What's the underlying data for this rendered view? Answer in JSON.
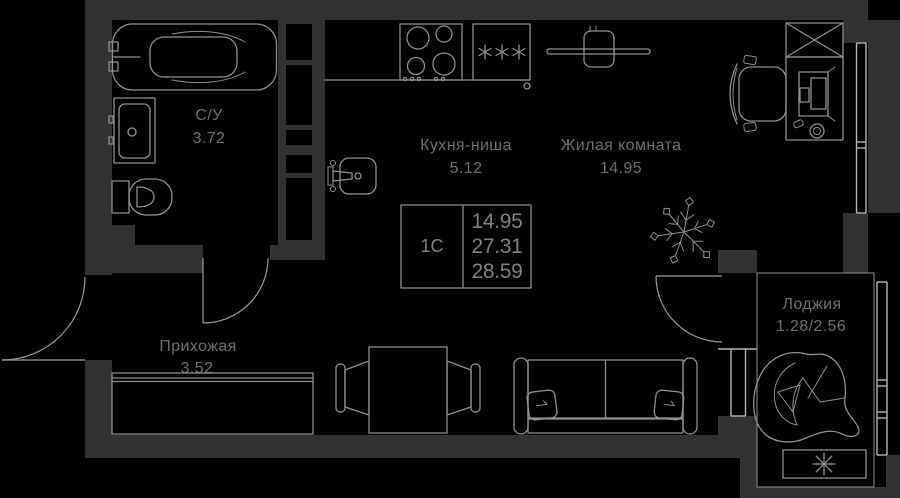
{
  "plan_type": "apartment-floor-plan",
  "info_box": {
    "unit": "1С",
    "values": [
      "14.95",
      "27.31",
      "28.59"
    ]
  },
  "rooms": [
    {
      "name": "С/У",
      "area": "3.72"
    },
    {
      "name": "Кухня-ниша",
      "area": "5.12"
    },
    {
      "name": "Жилая комната",
      "area": "14.95"
    },
    {
      "name": "Прихожая",
      "area": "3.52"
    },
    {
      "name": "Лоджия",
      "area": "1.28/2.56"
    }
  ],
  "fixtures": [
    "bathtub-icon",
    "bathroom-sink-icon",
    "toilet-icon",
    "stove-icon",
    "fridge-icon",
    "tv-icon",
    "kitchen-sink-icon",
    "hallway-wardrobe-icon",
    "dining-table-icon",
    "dining-chair-icon",
    "sofa-icon",
    "plant-icon",
    "closet-icon",
    "desk-icon",
    "office-chair-icon",
    "monitor-icon",
    "mug-icon",
    "hanging-chair-icon",
    "ac-unit-icon",
    "entrance-door-icon",
    "bathroom-door-icon",
    "balcony-door-icon",
    "window-icon"
  ],
  "colors": {
    "background": "#000000",
    "wall": "#323232",
    "line": "#8f8f8f",
    "window": "#b5b5b5",
    "label": "#6f6f6f"
  }
}
